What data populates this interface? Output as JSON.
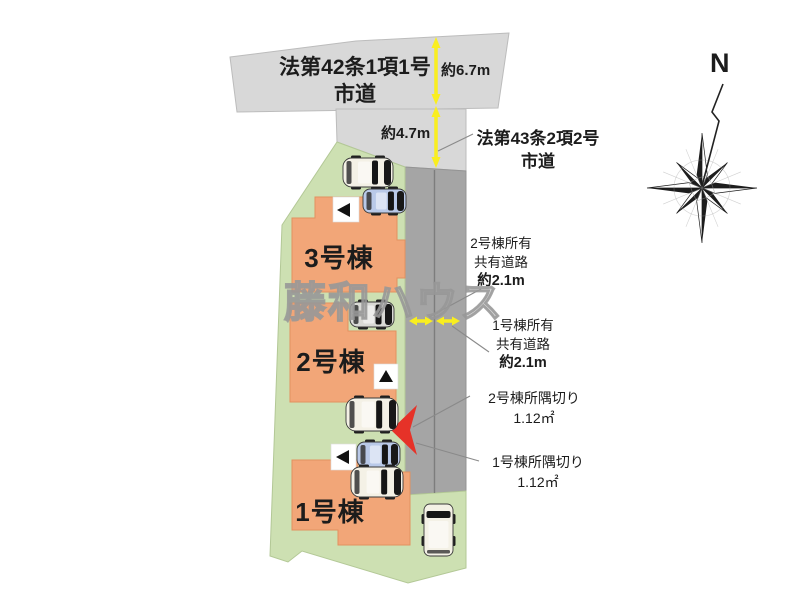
{
  "colors": {
    "lot-green": "#cde0b2",
    "building-salmon": "#f2a678",
    "road-light": "#d8d8d8",
    "road-dark": "#a5a5a5",
    "accent-yellow": "#f9ee1f",
    "arrow-red": "#e63228",
    "text-black": "#1c1c1c",
    "watermark-gray": "#a5a5a5",
    "car-white": "#f4f1e6",
    "car-blue": "#b9c9e8",
    "car-silver": "#d9d9d5"
  },
  "roads": {
    "top_road": {
      "line1": "法第42条1項1号",
      "line2": "市道"
    },
    "side_road": {
      "line1": "法第43条2項2号",
      "line2": "市道"
    }
  },
  "dimensions": {
    "top_road_width": "約6.7m",
    "side_road_width": "約4.7m"
  },
  "buildings": [
    {
      "name": "1号棟"
    },
    {
      "name": "2号棟"
    },
    {
      "name": "3号棟"
    }
  ],
  "shared_roads": [
    {
      "owner": "2号棟所有",
      "type": "共有道路",
      "width": "約2.1m"
    },
    {
      "owner": "1号棟所有",
      "type": "共有道路",
      "width": "約2.1m"
    }
  ],
  "corner_cuts": [
    {
      "label": "2号棟所隅切り",
      "area": "1.12㎡"
    },
    {
      "label": "1号棟所隅切り",
      "area": "1.12㎡"
    }
  ],
  "compass": {
    "label": "N"
  },
  "watermark": "藤和ハウス"
}
